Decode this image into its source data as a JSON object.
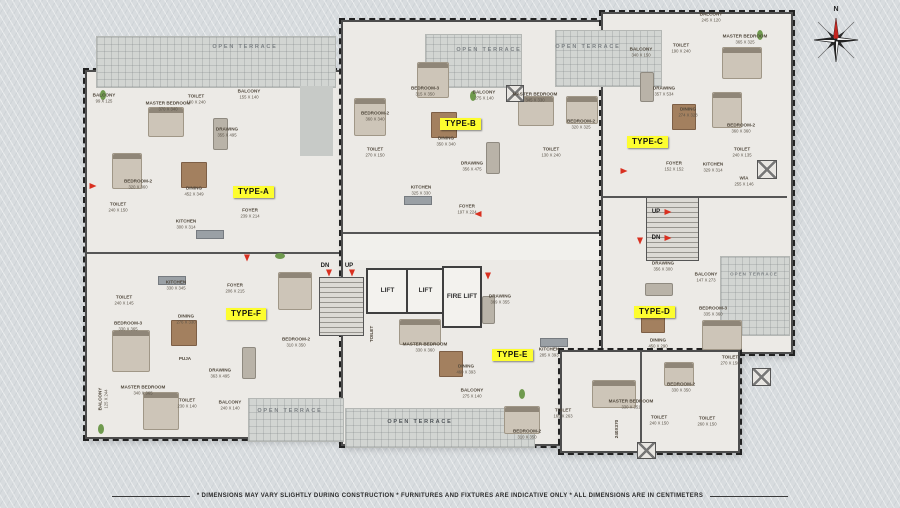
{
  "plan": {
    "compass": {
      "label": "N"
    },
    "disclaimer": "* DIMENSIONS MAY VARY SLIGHTLY DURING CONSTRUCTION * FURNITURES AND FIXTURES ARE INDICATIVE ONLY * ALL DIMENSIONS ARE IN CENTIMETERS",
    "colors": {
      "type_tag_bg": "#fdfd2f",
      "arrow_red": "#d93020",
      "wall": "#4d4d4d"
    },
    "type_tags": [
      {
        "label": "TYPE-A",
        "x": 233,
        "y": 186
      },
      {
        "label": "TYPE-B",
        "x": 440,
        "y": 118
      },
      {
        "label": "TYPE-C",
        "x": 627,
        "y": 136
      },
      {
        "label": "TYPE-D",
        "x": 634,
        "y": 306
      },
      {
        "label": "TYPE-E",
        "x": 492,
        "y": 349
      },
      {
        "label": "TYPE-F",
        "x": 226,
        "y": 308
      }
    ],
    "lifts": [
      {
        "label": "LIFT",
        "x": 366,
        "y": 268,
        "w": 39,
        "h": 42
      },
      {
        "label": "LIFT",
        "x": 406,
        "y": 268,
        "w": 35,
        "h": 42
      },
      {
        "label": "FIRE LIFT",
        "x": 442,
        "y": 266,
        "w": 36,
        "h": 58
      }
    ],
    "shafts": [
      {
        "x": 506,
        "y": 85,
        "w": 16,
        "h": 15
      },
      {
        "x": 757,
        "y": 160,
        "w": 18,
        "h": 17
      },
      {
        "x": 752,
        "y": 368,
        "w": 17,
        "h": 16
      },
      {
        "x": 637,
        "y": 442,
        "w": 17,
        "h": 15
      }
    ],
    "stairs": [
      {
        "x": 319,
        "y": 277,
        "w": 43,
        "h": 57
      },
      {
        "x": 646,
        "y": 197,
        "w": 51,
        "h": 62
      }
    ],
    "stair_labels": [
      {
        "t": "DN",
        "x": 325,
        "y": 266
      },
      {
        "t": "UP",
        "x": 349,
        "y": 266
      },
      {
        "t": "UP",
        "x": 656,
        "y": 212
      },
      {
        "t": "DN",
        "x": 656,
        "y": 238
      }
    ],
    "arrows": [
      {
        "d": "down",
        "x": 247,
        "y": 258
      },
      {
        "d": "down",
        "x": 488,
        "y": 276
      },
      {
        "d": "down",
        "x": 640,
        "y": 241
      },
      {
        "d": "right",
        "x": 624,
        "y": 171
      },
      {
        "d": "down",
        "x": 329,
        "y": 273
      },
      {
        "d": "down",
        "x": 352,
        "y": 273
      },
      {
        "d": "right",
        "x": 668,
        "y": 212
      },
      {
        "d": "right",
        "x": 668,
        "y": 238
      },
      {
        "d": "left",
        "x": 478,
        "y": 214
      },
      {
        "d": "right",
        "x": 93,
        "y": 186
      }
    ],
    "terrace_labels": [
      {
        "t": "OPEN TERRACE",
        "x": 245,
        "y": 47
      },
      {
        "t": "OPEN TERRACE",
        "x": 489,
        "y": 50
      },
      {
        "t": "OPEN TERRACE",
        "x": 588,
        "y": 47
      },
      {
        "t": "OPEN TERRACE",
        "x": 290,
        "y": 411
      },
      {
        "t": "OPEN TERRACE",
        "x": 420,
        "y": 422,
        "dark": true
      },
      {
        "t": "OPEN TERRACE",
        "x": 754,
        "y": 274,
        "small": true
      }
    ],
    "rooms": [
      {
        "n": "MASTER BEDROOM",
        "d": "370 X 340",
        "x": 168,
        "y": 106
      },
      {
        "n": "TOILET",
        "d": "130 X 240",
        "x": 196,
        "y": 99
      },
      {
        "n": "BALCONY",
        "d": "155 X 140",
        "x": 249,
        "y": 94
      },
      {
        "n": "BALCONY",
        "d": "99 X 125",
        "x": 104,
        "y": 98
      },
      {
        "n": "DRAWING",
        "d": "355 X 495",
        "x": 227,
        "y": 132
      },
      {
        "n": "BEDROOM-2",
        "d": "320 X 360",
        "x": 138,
        "y": 184
      },
      {
        "n": "DINING",
        "d": "452 X 349",
        "x": 194,
        "y": 191
      },
      {
        "n": "TOILET",
        "d": "240 X 150",
        "x": 118,
        "y": 207
      },
      {
        "n": "KITCHEN",
        "d": "300 X 314",
        "x": 186,
        "y": 224
      },
      {
        "n": "FOYER",
        "d": "239 X 214",
        "x": 250,
        "y": 213
      },
      {
        "n": "TOILET",
        "d": "240 X 145",
        "x": 124,
        "y": 300
      },
      {
        "n": "KITCHEN",
        "d": "330 X 345",
        "x": 176,
        "y": 285
      },
      {
        "n": "FOYER",
        "d": "206 X 215",
        "x": 235,
        "y": 288
      },
      {
        "n": "DINING",
        "d": "276 X 330",
        "x": 186,
        "y": 319
      },
      {
        "n": "BEDROOM-3",
        "d": "330 X 365",
        "x": 128,
        "y": 326
      },
      {
        "n": "BEDROOM-2",
        "d": "310 X 350",
        "x": 296,
        "y": 342
      },
      {
        "n": "MASTER BEDROOM",
        "d": "340 X 365",
        "x": 143,
        "y": 390
      },
      {
        "n": "BALCONY",
        "d": "125 X 244",
        "x": 103,
        "y": 399,
        "rot": -90
      },
      {
        "n": "PUJA",
        "d": "",
        "x": 185,
        "y": 359
      },
      {
        "n": "DRAWING",
        "d": "363 X 495",
        "x": 220,
        "y": 373
      },
      {
        "n": "TOILET",
        "d": "230 X 140",
        "x": 187,
        "y": 403
      },
      {
        "n": "BALCONY",
        "d": "240 X 140",
        "x": 230,
        "y": 405
      },
      {
        "n": "BEDROOM-2",
        "d": "360 X 340",
        "x": 375,
        "y": 116
      },
      {
        "n": "BEDROOM-3",
        "d": "315 X 350",
        "x": 425,
        "y": 91
      },
      {
        "n": "BALCONY",
        "d": "275 X 140",
        "x": 484,
        "y": 95
      },
      {
        "n": "DINING",
        "d": "350 X 340",
        "x": 446,
        "y": 141
      },
      {
        "n": "DRAWING",
        "d": "356 X 475",
        "x": 472,
        "y": 166
      },
      {
        "n": "TOILET",
        "d": "270 X 150",
        "x": 375,
        "y": 152
      },
      {
        "n": "KITCHEN",
        "d": "325 X 330",
        "x": 421,
        "y": 190
      },
      {
        "n": "FOYER",
        "d": "197 X 224",
        "x": 467,
        "y": 209
      },
      {
        "n": "MASTER BEDROOM",
        "d": "345 X 330",
        "x": 535,
        "y": 97
      },
      {
        "n": "BEDROOM-2",
        "d": "320 X 325",
        "x": 581,
        "y": 124
      },
      {
        "n": "TOILET",
        "d": "130 X 240",
        "x": 551,
        "y": 152
      },
      {
        "n": "BALCONY",
        "d": "245 X 120",
        "x": 711,
        "y": 17
      },
      {
        "n": "BALCONY",
        "d": "340 X 150",
        "x": 641,
        "y": 52
      },
      {
        "n": "TOILET",
        "d": "190 X 240",
        "x": 681,
        "y": 48
      },
      {
        "n": "MASTER BEDROOM",
        "d": "365 X 325",
        "x": 745,
        "y": 39
      },
      {
        "n": "DRAWING",
        "d": "357 X 534",
        "x": 664,
        "y": 91
      },
      {
        "n": "DINING",
        "d": "274 X 328",
        "x": 688,
        "y": 112
      },
      {
        "n": "BEDROOM-2",
        "d": "360 X 360",
        "x": 741,
        "y": 128
      },
      {
        "n": "FOYER",
        "d": "152 X 152",
        "x": 674,
        "y": 166
      },
      {
        "n": "KITCHEN",
        "d": "329 X 314",
        "x": 713,
        "y": 167
      },
      {
        "n": "TOILET",
        "d": "240 X 135",
        "x": 742,
        "y": 152
      },
      {
        "n": "W/A",
        "d": "255 X 146",
        "x": 744,
        "y": 181
      },
      {
        "n": "DRAWING",
        "d": "356 X 300",
        "x": 663,
        "y": 266
      },
      {
        "n": "BALCONY",
        "d": "147 X 273",
        "x": 706,
        "y": 277
      },
      {
        "n": "BEDROOM-3",
        "d": "335 X 360",
        "x": 713,
        "y": 311
      },
      {
        "n": "DINING",
        "d": "450 X 290",
        "x": 658,
        "y": 343
      },
      {
        "n": "TOILET",
        "d": "270 X 150",
        "x": 730,
        "y": 360
      },
      {
        "n": "BEDROOM-2",
        "d": "330 X 350",
        "x": 681,
        "y": 387
      },
      {
        "n": "TOILET",
        "d": "260 X 150",
        "x": 707,
        "y": 421
      },
      {
        "n": "MASTER BEDROOM",
        "d": "330 X 351",
        "x": 631,
        "y": 404
      },
      {
        "n": "TOILET",
        "d": "240 X 150",
        "x": 659,
        "y": 420
      },
      {
        "n": "240X370",
        "d": "",
        "x": 617,
        "y": 429,
        "rot": -90
      },
      {
        "n": "DRAWING",
        "d": "369 X 355",
        "x": 500,
        "y": 299
      },
      {
        "n": "MASTER BEDROOM",
        "d": "330 X 360",
        "x": 425,
        "y": 347
      },
      {
        "n": "TOILET",
        "d": "",
        "x": 372,
        "y": 334,
        "rot": -90
      },
      {
        "n": "DINING",
        "d": "460 X 393",
        "x": 466,
        "y": 369
      },
      {
        "n": "KITCHEN",
        "d": "285 X 393",
        "x": 549,
        "y": 352
      },
      {
        "n": "BALCONY",
        "d": "275 X 140",
        "x": 472,
        "y": 393
      },
      {
        "n": "BEDROOM-2",
        "d": "310 X 350",
        "x": 527,
        "y": 434
      },
      {
        "n": "TOILET",
        "d": "165 X 263",
        "x": 563,
        "y": 413
      }
    ],
    "furniture": [
      {
        "t": "bed",
        "x": 148,
        "y": 107,
        "w": 34,
        "h": 28
      },
      {
        "t": "bed",
        "x": 112,
        "y": 153,
        "w": 28,
        "h": 34
      },
      {
        "t": "bed",
        "x": 112,
        "y": 330,
        "w": 36,
        "h": 40
      },
      {
        "t": "bed",
        "x": 143,
        "y": 392,
        "w": 34,
        "h": 36
      },
      {
        "t": "bed",
        "x": 278,
        "y": 272,
        "w": 32,
        "h": 36
      },
      {
        "t": "bed",
        "x": 354,
        "y": 98,
        "w": 30,
        "h": 36
      },
      {
        "t": "bed",
        "x": 417,
        "y": 62,
        "w": 30,
        "h": 34
      },
      {
        "t": "bed",
        "x": 518,
        "y": 96,
        "w": 34,
        "h": 28
      },
      {
        "t": "bed",
        "x": 566,
        "y": 96,
        "w": 30,
        "h": 26
      },
      {
        "t": "bed",
        "x": 722,
        "y": 47,
        "w": 38,
        "h": 30
      },
      {
        "t": "bed",
        "x": 712,
        "y": 92,
        "w": 28,
        "h": 34
      },
      {
        "t": "bed",
        "x": 702,
        "y": 320,
        "w": 38,
        "h": 28
      },
      {
        "t": "bed",
        "x": 664,
        "y": 362,
        "w": 28,
        "h": 22
      },
      {
        "t": "bed",
        "x": 592,
        "y": 380,
        "w": 42,
        "h": 26
      },
      {
        "t": "bed",
        "x": 399,
        "y": 319,
        "w": 40,
        "h": 24
      },
      {
        "t": "bed",
        "x": 504,
        "y": 406,
        "w": 34,
        "h": 26
      },
      {
        "t": "table",
        "x": 181,
        "y": 162,
        "w": 24,
        "h": 24
      },
      {
        "t": "table",
        "x": 171,
        "y": 320,
        "w": 24,
        "h": 24
      },
      {
        "t": "table",
        "x": 431,
        "y": 112,
        "w": 24,
        "h": 24
      },
      {
        "t": "table",
        "x": 672,
        "y": 104,
        "w": 22,
        "h": 24
      },
      {
        "t": "table",
        "x": 641,
        "y": 307,
        "w": 22,
        "h": 24
      },
      {
        "t": "table",
        "x": 439,
        "y": 351,
        "w": 22,
        "h": 24
      },
      {
        "t": "sofa",
        "x": 213,
        "y": 118,
        "w": 13,
        "h": 30
      },
      {
        "t": "sofa",
        "x": 242,
        "y": 347,
        "w": 12,
        "h": 30
      },
      {
        "t": "sofa",
        "x": 486,
        "y": 142,
        "w": 12,
        "h": 30
      },
      {
        "t": "sofa",
        "x": 640,
        "y": 72,
        "w": 12,
        "h": 28
      },
      {
        "t": "sofa",
        "x": 645,
        "y": 283,
        "w": 26,
        "h": 11
      },
      {
        "t": "sofa",
        "x": 482,
        "y": 296,
        "w": 11,
        "h": 26
      },
      {
        "t": "counter",
        "x": 196,
        "y": 230,
        "w": 26,
        "h": 7
      },
      {
        "t": "counter",
        "x": 158,
        "y": 276,
        "w": 26,
        "h": 7
      },
      {
        "t": "counter",
        "x": 404,
        "y": 196,
        "w": 26,
        "h": 7
      },
      {
        "t": "counter",
        "x": 540,
        "y": 338,
        "w": 26,
        "h": 7
      },
      {
        "t": "plant",
        "x": 100,
        "y": 90,
        "w": 6,
        "h": 10
      },
      {
        "t": "plant",
        "x": 470,
        "y": 91,
        "w": 6,
        "h": 10
      },
      {
        "t": "plant",
        "x": 757,
        "y": 30,
        "w": 6,
        "h": 10
      },
      {
        "t": "plant",
        "x": 519,
        "y": 389,
        "w": 6,
        "h": 10
      },
      {
        "t": "plant",
        "x": 98,
        "y": 424,
        "w": 6,
        "h": 10
      },
      {
        "t": "plant",
        "x": 275,
        "y": 253,
        "w": 10,
        "h": 6
      }
    ]
  }
}
